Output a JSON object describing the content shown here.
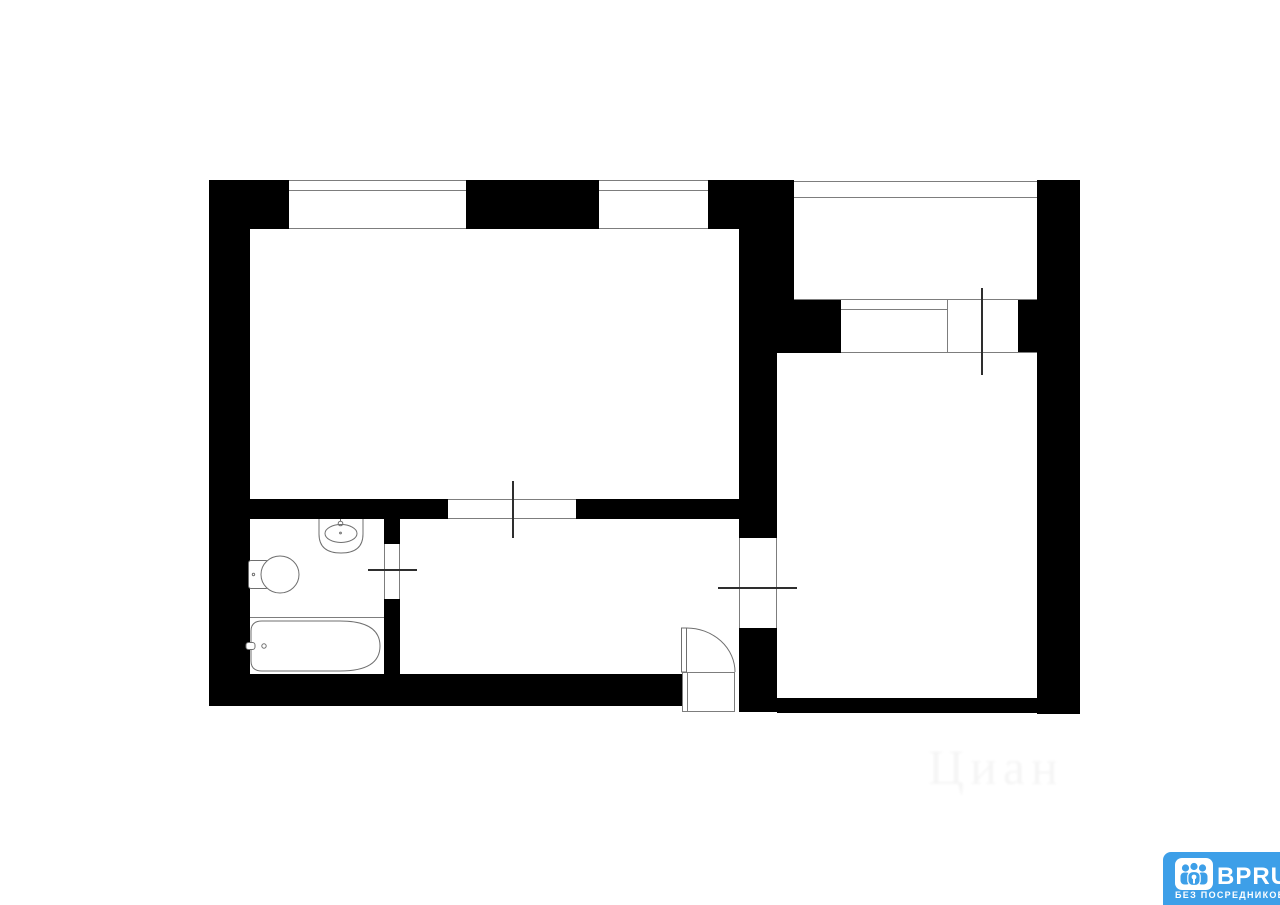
{
  "colors": {
    "background": "#ffffff",
    "wall": "#000000",
    "thin_line": "#7d7d7d",
    "tick": "#2e2e2e",
    "fixture_stroke": "#6f6f6f",
    "logo_blue": "#3d9fe8",
    "logo_text": "#ffffff"
  },
  "logo": {
    "brand": "BPRU",
    "tagline": "БЕЗ ПОСРЕДНИКОВ"
  },
  "watermark": {
    "text": "Циан"
  }
}
